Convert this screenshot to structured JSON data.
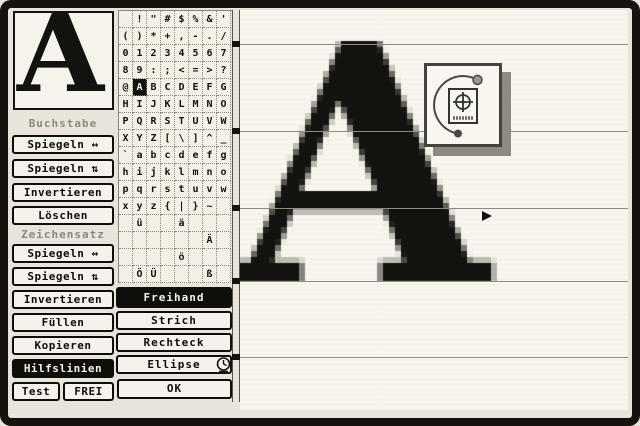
{
  "preview": {
    "glyph": "A"
  },
  "left_panel": {
    "sections": [
      {
        "label": "Buchstabe",
        "buttons": [
          "Spiegeln ↔",
          "Spiegeln ⇅",
          "Invertieren",
          "Löschen"
        ]
      },
      {
        "label": "Zeichensatz",
        "buttons": [
          "Spiegeln ↔",
          "Spiegeln ⇅",
          "Invertieren",
          "Füllen"
        ]
      }
    ],
    "buttons": [
      "Kopieren",
      "Hilfslinien"
    ],
    "active_button": "Hilfslinien",
    "bottom_buttons": [
      "Test",
      "FREI"
    ]
  },
  "charset_grid": {
    "columns": 8,
    "selected_char": "A",
    "selected_row": 4,
    "selected_col": 1,
    "rows": [
      [
        " ",
        "!",
        "\"",
        "#",
        "$",
        "%",
        "&",
        "'"
      ],
      [
        "(",
        ")",
        "*",
        "+",
        ",",
        "-",
        ".",
        "/"
      ],
      [
        "0",
        "1",
        "2",
        "3",
        "4",
        "5",
        "6",
        "7"
      ],
      [
        "8",
        "9",
        ":",
        ";",
        "<",
        "=",
        ">",
        "?"
      ],
      [
        "@",
        "A",
        "B",
        "C",
        "D",
        "E",
        "F",
        "G"
      ],
      [
        "H",
        "I",
        "J",
        "K",
        "L",
        "M",
        "N",
        "O"
      ],
      [
        "P",
        "Q",
        "R",
        "S",
        "T",
        "U",
        "V",
        "W"
      ],
      [
        "X",
        "Y",
        "Z",
        "[",
        "\\",
        "]",
        "^",
        "_"
      ],
      [
        "`",
        "a",
        "b",
        "c",
        "d",
        "e",
        "f",
        "g"
      ],
      [
        "h",
        "i",
        "j",
        "k",
        "l",
        "m",
        "n",
        "o"
      ],
      [
        "p",
        "q",
        "r",
        "s",
        "t",
        "u",
        "v",
        "w"
      ],
      [
        "x",
        "y",
        "z",
        "{",
        "|",
        "}",
        "~",
        ""
      ],
      [
        "",
        "ü",
        "",
        "",
        "ä",
        "",
        "",
        ""
      ],
      [
        "",
        "",
        "",
        "",
        "",
        "",
        "Ä",
        ""
      ],
      [
        "",
        "",
        "",
        "",
        "ö",
        "",
        "",
        ""
      ],
      [
        "",
        "Ö",
        "Ü",
        "",
        "",
        "",
        "ß",
        ""
      ]
    ]
  },
  "tools": {
    "items": [
      "Freihand",
      "Strich",
      "Rechteck",
      "Ellipse"
    ],
    "active": "Freihand",
    "ok": "OK",
    "busy_icon": "clock-icon"
  },
  "canvas": {
    "glyph": "A",
    "guidelines_y": [
      44,
      131,
      208,
      281,
      357
    ],
    "cursor": {
      "x": 482,
      "y": 207
    }
  },
  "floating_tool": {
    "icon": "crosshair-target-icon"
  },
  "colors": {
    "ink": "#14120e",
    "paper": "#e9e5dc",
    "button_face": "#f5f2eb",
    "selected_bg": "#14120e",
    "guideline": "#8f8c83"
  }
}
